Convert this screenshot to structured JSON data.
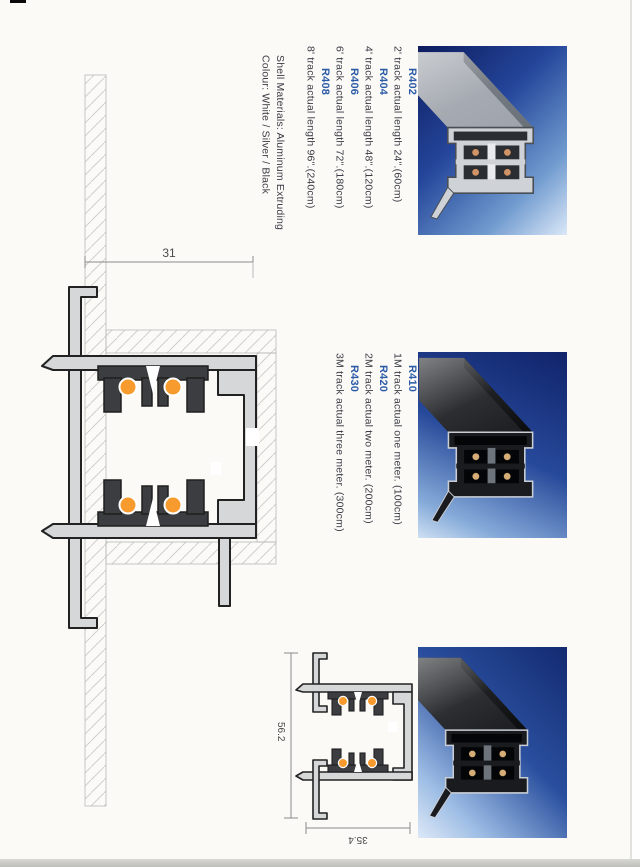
{
  "track_lengths": {
    "items": [
      {
        "code": "R402",
        "desc": "2' track actual length 24\".(60cm)"
      },
      {
        "code": "R404",
        "desc": "4' track actual length 48\".(120cm)"
      },
      {
        "code": "R406",
        "desc": "6' track actual length 72\".(180cm)"
      },
      {
        "code": "R408",
        "desc": "8' track actual length 96\".(240cm)"
      }
    ]
  },
  "materials": {
    "shell": "Shell Materials: Aluminum Extruding",
    "colour": "Colour: White / Silver / Black"
  },
  "track_meters": {
    "items": [
      {
        "code": "R410",
        "desc": "1M track actual one meter. (100cm)"
      },
      {
        "code": "R420",
        "desc": "2M track actual two meter. (200cm)"
      },
      {
        "code": "R430",
        "desc": "3M track actual three meter. (300cm)"
      }
    ]
  },
  "dimensions": {
    "recessed_pocket_width": "31",
    "surface_total_height": "56.2",
    "surface_total_width": "35.4"
  },
  "colors": {
    "code_blue": "#2b5aa6",
    "conductor_orange": "#f79b2e",
    "photo_navy": "#13246b"
  }
}
